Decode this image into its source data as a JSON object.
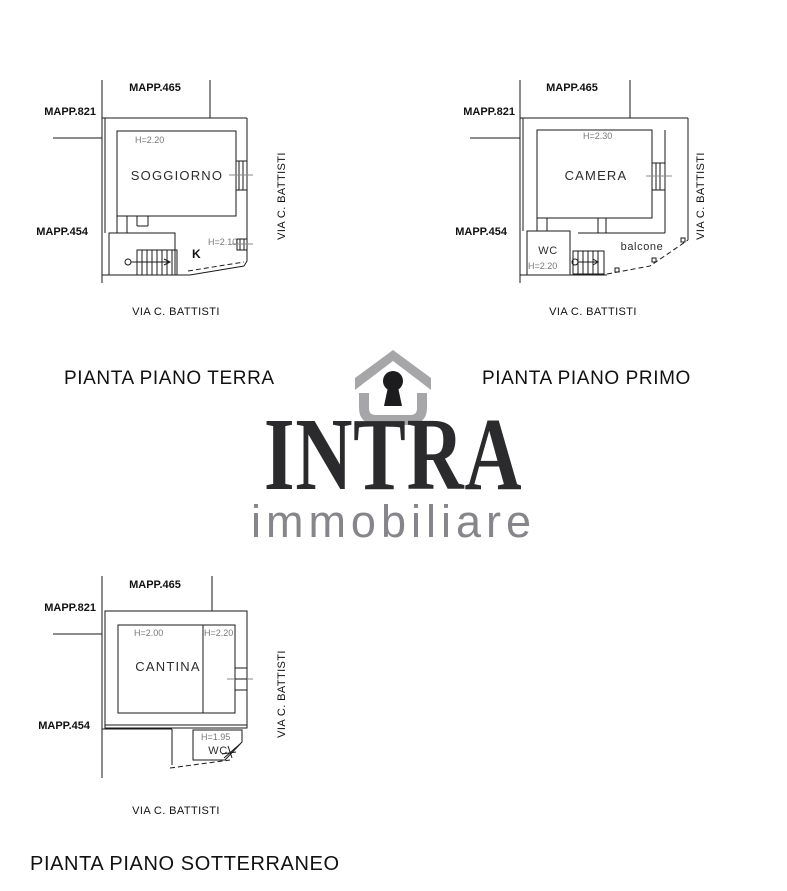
{
  "logo": {
    "brand": "INTRA",
    "subtitle": "immobiliare",
    "icon": "house-keyhole",
    "colors": {
      "brand": "#2b2b2d",
      "subtitle": "#85858a",
      "icon_gray": "#a6a6a8",
      "keyhole": "#1c1c1e"
    }
  },
  "plans": {
    "terra": {
      "caption": "PIANTA PIANO TERRA",
      "mapp_top": "MAPP.465",
      "mapp_left_upper": "MAPP.821",
      "mapp_left_lower": "MAPP.454",
      "street_right": "VIA C. BATTISTI",
      "street_bottom": "VIA C. BATTISTI",
      "room_main": "SOGGIORNO",
      "room_main_height": "H=2.20",
      "room_k": "K",
      "room_k_height": "H=2.10"
    },
    "primo": {
      "caption": "PIANTA PIANO PRIMO",
      "mapp_top": "MAPP.465",
      "mapp_left_upper": "MAPP.821",
      "mapp_left_lower": "MAPP.454",
      "street_right": "VIA C. BATTISTI",
      "street_bottom": "VIA C. BATTISTI",
      "room_main": "CAMERA",
      "room_main_height": "H=2.30",
      "room_wc": "WC",
      "room_wc_height": "H=2.20",
      "balcony": "balcone"
    },
    "sotterraneo": {
      "caption": "PIANTA PIANO SOTTERRANEO",
      "mapp_top": "MAPP.465",
      "mapp_left_upper": "MAPP.821",
      "mapp_left_lower": "MAPP.454",
      "street_right": "VIA C. BATTISTI",
      "street_bottom": "VIA C. BATTISTI",
      "room_main": "CANTINA",
      "room_main_height_left": "H=2.00",
      "room_main_height_right": "H=2.20",
      "room_wc": "WC",
      "room_wc_height": "H=1.95"
    }
  }
}
